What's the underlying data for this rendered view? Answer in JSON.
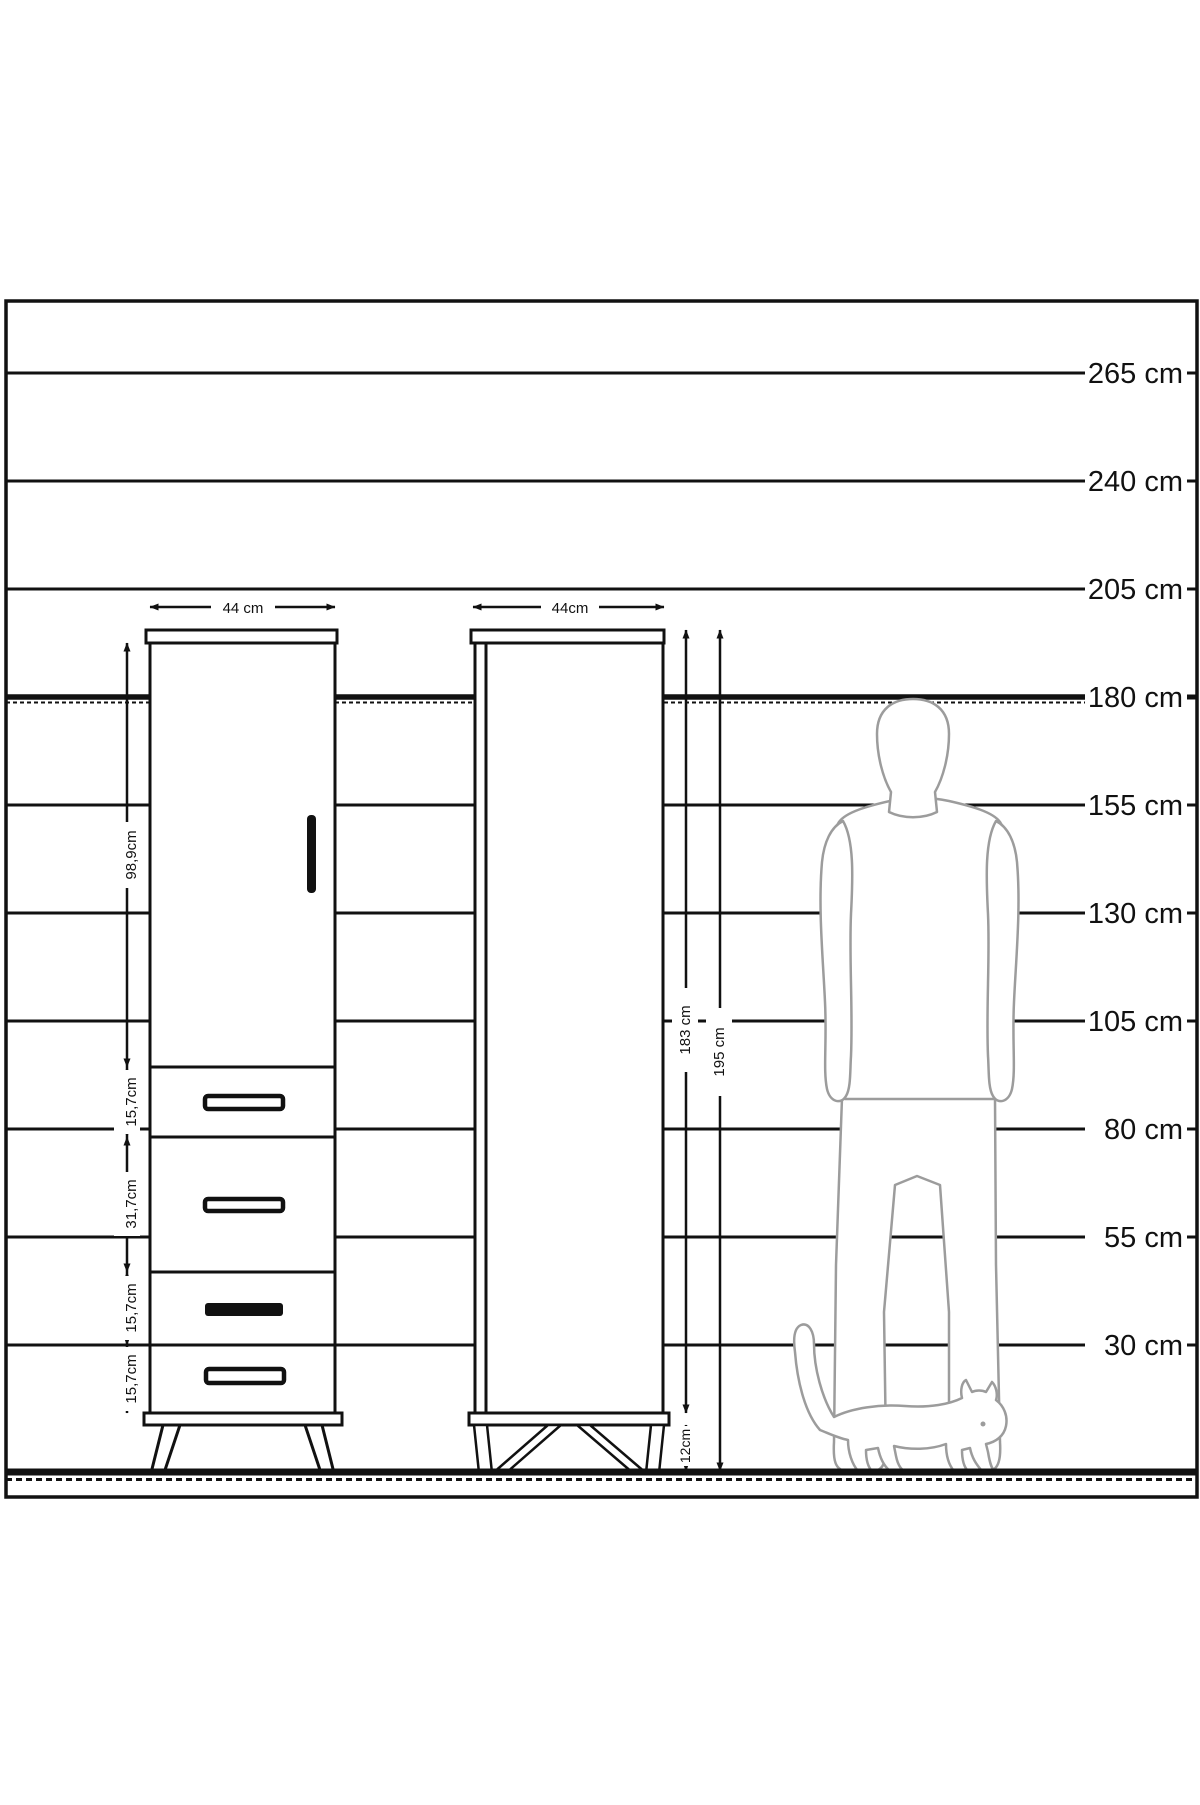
{
  "figure": {
    "type": "furniture-dimension-diagram",
    "unit": "cm"
  },
  "scale": {
    "labels": [
      "265 cm",
      "240 cm",
      "205 cm",
      "180 cm",
      "155 cm",
      "130 cm",
      "105 cm",
      "80 cm",
      "55 cm",
      "30 cm"
    ],
    "emphasized_label": "180 cm"
  },
  "cabinet_front": {
    "width_label": "44 cm",
    "section_labels": [
      "98,9cm",
      "15,7cm",
      "31,7cm",
      "15,7cm",
      "15,7cm"
    ]
  },
  "cabinet_side": {
    "width_label": "44cm",
    "body_height_label": "183 cm",
    "total_height_label": "195 cm",
    "leg_height_label": "12cm"
  },
  "silhouettes": {
    "person": "man-back-view-silhouette",
    "animal": "walking-cat-silhouette"
  },
  "colors": {
    "line": "#111111",
    "silhouette": "#9c9c9c",
    "background": "#ffffff"
  }
}
